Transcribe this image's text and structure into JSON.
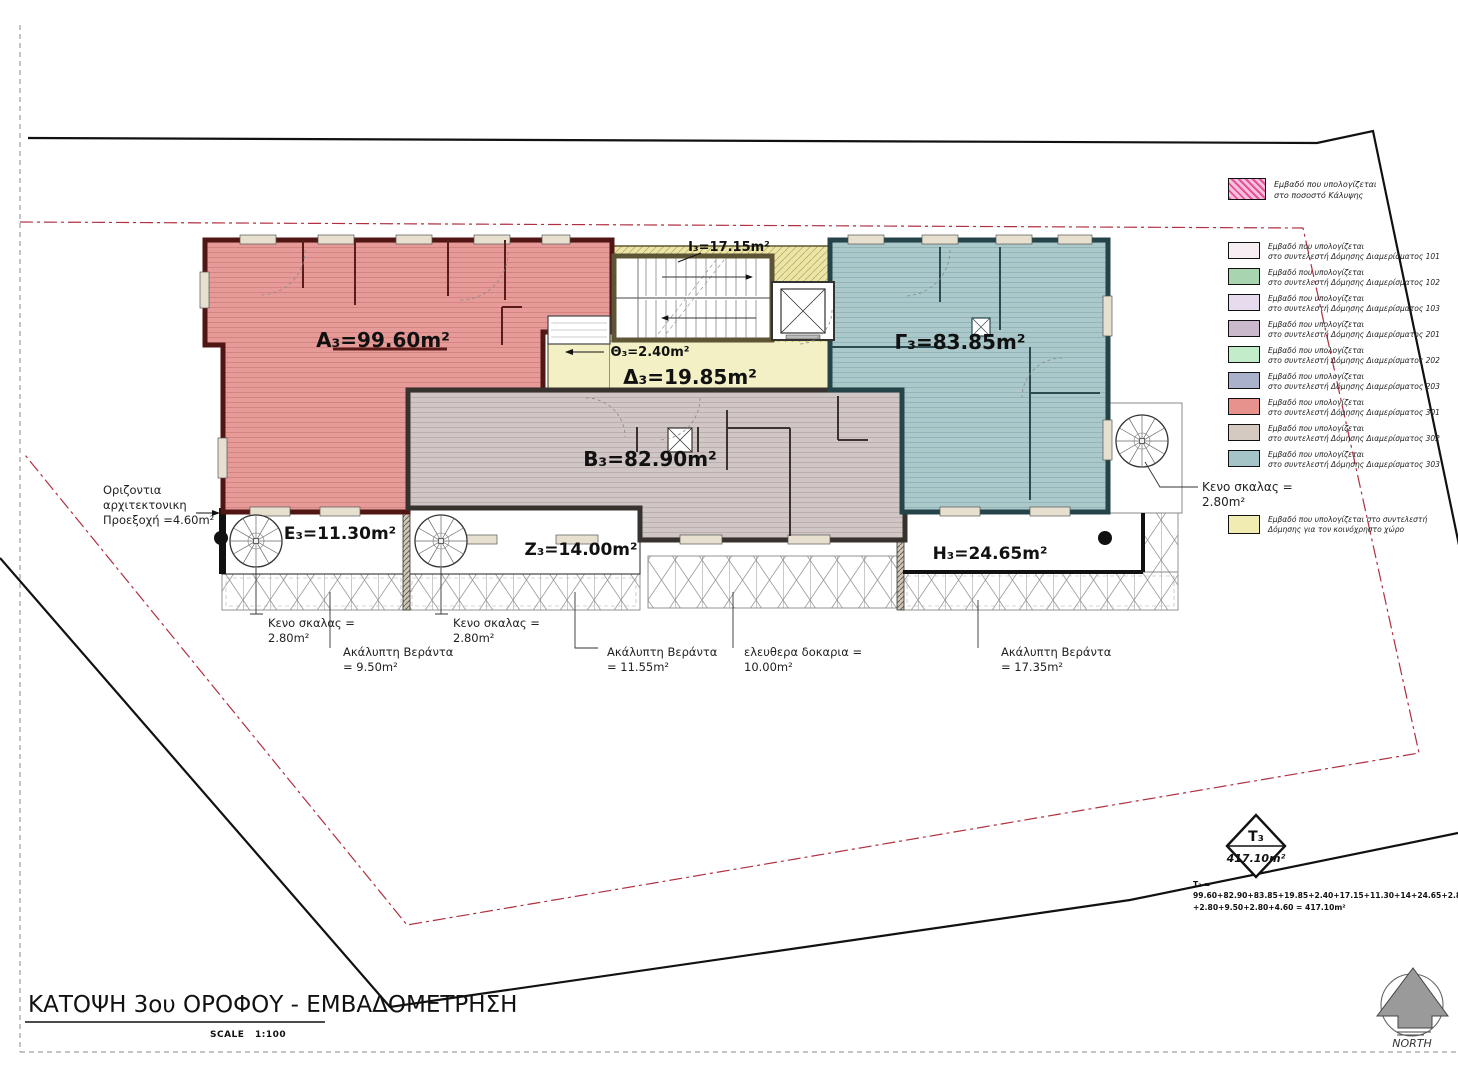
{
  "title": {
    "text": "ΚΑΤΟΨΗ 3ου ΟΡΟΦΟΥ - ΕΜΒΑΔΟΜΕΤΡΗΣΗ",
    "scale_word": "SCALE",
    "scale_value": "1:100"
  },
  "north": {
    "label": "NORTH"
  },
  "rooms": {
    "a3": {
      "label": "A₃=99.60m²",
      "color": "#e69b98"
    },
    "b3": {
      "label": "B₃=82.90m²",
      "color": "#d0c6c5"
    },
    "g3": {
      "label": "Γ₃=83.85m²",
      "color": "#abc8ca"
    },
    "d3": {
      "label": "Δ₃=19.85m²",
      "color": "#f4f0c6"
    },
    "e3": {
      "label": "E₃=11.30m²",
      "color": "#ffffff"
    },
    "z3": {
      "label": "Z₃=14.00m²",
      "color": "#ffffff"
    },
    "h3": {
      "label": "H₃=24.65m²",
      "color": "#ffffff"
    },
    "th3": {
      "label": "Θ₃=2.40m²",
      "color": "#ffffff"
    },
    "i3": {
      "label": "I₃=17.15m²",
      "color": "#ffffff"
    }
  },
  "annotations": {
    "projection": {
      "l1": "Οριζοντια",
      "l2": "αρχιτεκτονικη",
      "l3": "Προεξοχή =4.60m²"
    },
    "stair_void_e": {
      "l1": "Κενο σκαλας =",
      "l2": "2.80m²"
    },
    "stair_void_z": {
      "l1": "Κενο σκαλας =",
      "l2": "2.80m²"
    },
    "stair_void_r": {
      "l1": "Κενο σκαλας =",
      "l2": "2.80m²"
    },
    "veranda_e": {
      "l1": "Ακάλυπτη Βεράντα",
      "l2": "= 9.50m²"
    },
    "veranda_z": {
      "l1": "Ακάλυπτη Βεράντα",
      "l2": "= 11.55m²"
    },
    "beams": {
      "l1": "ελευθερα δοκαρια =",
      "l2": "10.00m²"
    },
    "veranda_h": {
      "l1": "Ακάλυπτη Βεράντα",
      "l2": "= 17.35m²"
    }
  },
  "totals": {
    "mark": "T₃",
    "value": "417.10m²",
    "sum_head": "T₃ =",
    "sum_line1": "99.60+82.90+83.85+19.85+2.40+17.15+11.30+14+24.65+2.80+17.35+10+11.55",
    "sum_line2": "+2.80+9.50+2.80+4.60 = 417.10m²"
  },
  "legend": {
    "coverage": {
      "l1": "Εμβαδό που υπολογίζεται",
      "l2": "στο ποσοστό Κάλυψης",
      "color": "#f6c3da"
    },
    "items": [
      {
        "l1": "Εμβαδό που υπολογίζεται",
        "l2": "στο συντελεστή Δόμησης Διαμερίσματος 101",
        "color": "#f7eef3"
      },
      {
        "l1": "Εμβαδό που υπολογίζεται",
        "l2": "στο συντελεστή Δόμησης Διαμερίσματος 102",
        "color": "#a8d4b0"
      },
      {
        "l1": "Εμβαδό που υπολογίζεται",
        "l2": "στο συντελεστή Δόμησης Διαμερίσματος 103",
        "color": "#e6dcee"
      },
      {
        "l1": "Εμβαδό που υπολογίζεται",
        "l2": "στο συντελεστή Δόμησης Διαμερίσματος 201",
        "color": "#c9b9ca"
      },
      {
        "l1": "Εμβαδό που υπολογίζεται",
        "l2": "στο συντελεστή Δόμησης Διαμερίσματος 202",
        "color": "#c2ecca"
      },
      {
        "l1": "Εμβαδό που υπολογίζεται",
        "l2": "στο συντελεστή Δόμησης Διαμερίσματος 203",
        "color": "#aab1ca"
      },
      {
        "l1": "Εμβαδό που υπολογίζεται",
        "l2": "στο συντελεστή Δόμησης Διαμερίσματος 301",
        "color": "#e8928d"
      },
      {
        "l1": "Εμβαδό που υπολογίζεται",
        "l2": "στο συντελεστή Δόμησης Διαμερίσματος 302",
        "color": "#d5cac2"
      },
      {
        "l1": "Εμβαδό που υπολογίζεται",
        "l2": "στο συντελεστή Δόμησης Διαμερίσματος 303",
        "color": "#a5c4c7"
      }
    ],
    "common": {
      "l1": "Εμβαδό που υπολογίζεται στο συντελεστή",
      "l2": "Δόμησης για τον κοινόχρηστο χώρο",
      "color": "#f1ecb2"
    }
  },
  "colors": {
    "boundary_black": "#111111",
    "setback_red": "#b03040",
    "wall_red": "#4f1613",
    "wall_gray": "#37322e",
    "wall_teal": "#24444a",
    "wall_olive": "#5d5535"
  }
}
